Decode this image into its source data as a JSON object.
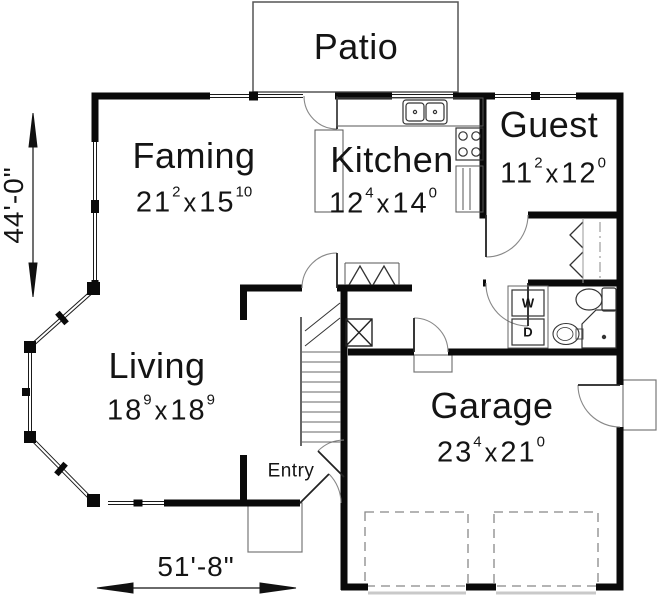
{
  "rooms": {
    "patio": {
      "name": "Patio"
    },
    "family": {
      "name": "Faming",
      "d1": "21",
      "d1s": "2",
      "sep": "x",
      "d2": "15",
      "d2s": "10"
    },
    "kitchen": {
      "name": "Kitchen",
      "d1": "12",
      "d1s": "4",
      "sep": "x",
      "d2": "14",
      "d2s": "0"
    },
    "guest": {
      "name": "Guest",
      "d1": "11",
      "d1s": "2",
      "sep": "x",
      "d2": "12",
      "d2s": "0"
    },
    "living": {
      "name": "Living",
      "d1": "18",
      "d1s": "9",
      "sep": "x",
      "d2": "18",
      "d2s": "9"
    },
    "garage": {
      "name": "Garage",
      "d1": "23",
      "d1s": "4",
      "sep": "x",
      "d2": "21",
      "d2s": "0"
    },
    "entry": {
      "name": "Entry"
    }
  },
  "dimensions": {
    "overall_depth": "44'-0\"",
    "overall_width": "51'-8\""
  },
  "fixtures": {
    "washer": "W",
    "dryer": "D"
  },
  "colors": {
    "wall": "#0a0a0a",
    "thin_line": "#555555",
    "background": "#ffffff"
  }
}
